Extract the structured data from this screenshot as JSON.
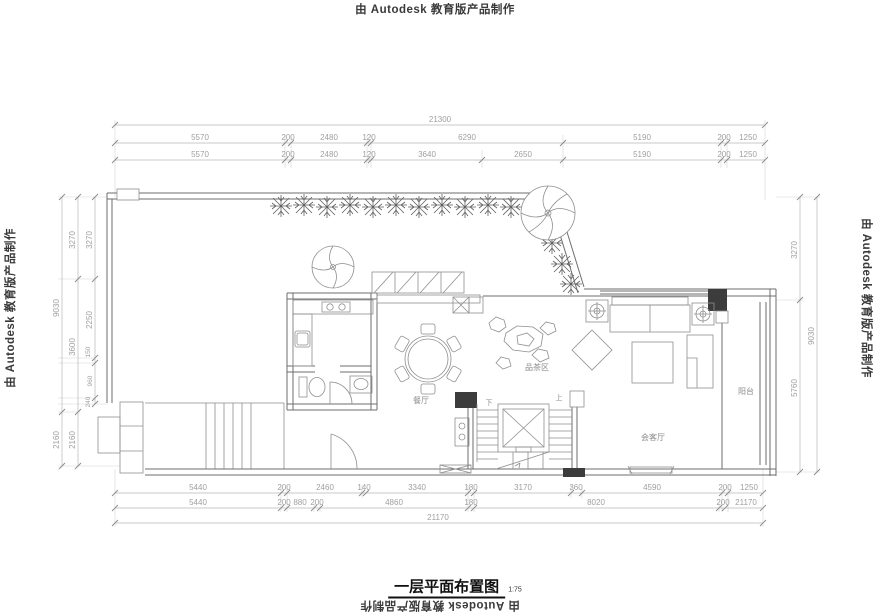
{
  "branding": {
    "stamp": "由 Autodesk 教育版产品制作"
  },
  "title": {
    "text": "一层平面布置图",
    "scale": "1:75"
  },
  "rooms": {
    "tea": "品茶区",
    "dining": "餐厅",
    "living": "会客厅",
    "balcony": "阳台",
    "stair_down": "下",
    "stair_up": "上"
  },
  "dims": {
    "top_total": "21300",
    "top_row1": [
      "5570",
      "200",
      "2480",
      "120",
      "6290",
      "5190",
      "200",
      "1250"
    ],
    "top_row2": [
      "5570",
      "200",
      "2480",
      "120",
      "3640",
      "2650",
      "5190",
      "200",
      "1250"
    ],
    "bottom_row1": [
      "5440",
      "200",
      "2460",
      "140",
      "3340",
      "180",
      "3170",
      "360",
      "4590",
      "200",
      "1250"
    ],
    "bottom_row2": [
      "5440",
      "200",
      "880",
      "200",
      "4860",
      "180",
      "8020",
      "200",
      "1250"
    ],
    "bottom_total": "21170",
    "left_outer": [
      "9030",
      "2160"
    ],
    "left_mid": [
      "3270",
      "3600",
      "2160"
    ],
    "left_inner": [
      "3270",
      "2250",
      "150",
      "960",
      "240"
    ],
    "right_inner": [
      "3270",
      "5760"
    ],
    "right_outer": "9030"
  },
  "colors": {
    "wall": "#6e6e6e",
    "dim_text": "#9f9f9f",
    "column_fill": "#3c3c3c"
  }
}
